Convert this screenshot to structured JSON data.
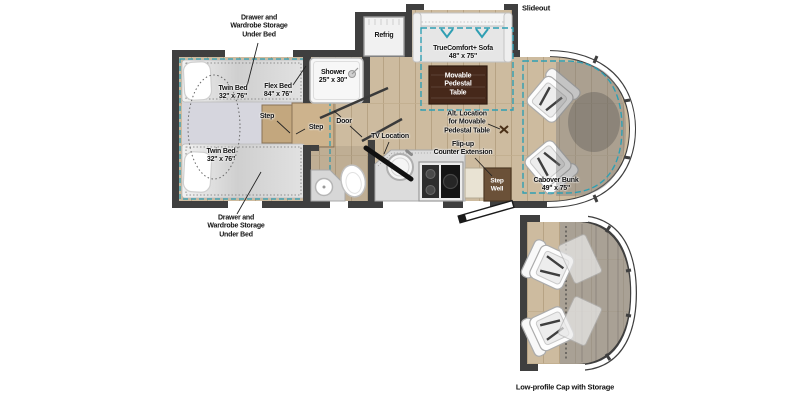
{
  "colors": {
    "wall": "#3f3f3f",
    "floor_wood": "#cdbb9f",
    "accent_teal": "#2f9fb3",
    "table_brown": "#46281a",
    "step_well_brown": "#6b5138",
    "fixture_white": "#f7f7f7",
    "window_white": "#ffffff"
  },
  "labels": {
    "drawer_top": "Drawer and\nWardrobe Storage\nUnder Bed",
    "twin_bed_top": "Twin Bed\n32\" x 76\"",
    "flex_bed": "Flex Bed\n84\" x 76\"",
    "shower": "Shower\n25\" x 30\"",
    "refrig": "Refrig",
    "slideout": "Slideout",
    "sofa": "TrueComfort+ Sofa\n48\" x 75\"",
    "pedestal_table": "Movable\nPedestal\nTable",
    "alt_table": "Alt. Location\nfor Movable\nPedestal Table",
    "flip_up_counter": "Flip-up\nCounter Extension",
    "tv_location": "TV Location",
    "step_1": "Step",
    "step_2": "Step",
    "door": "Door",
    "twin_bed_bottom": "Twin Bed\n32\" x 76\"",
    "drawer_bottom": "Drawer and\nWardrobe Storage\nUnder Bed",
    "step_well": "Step\nWell",
    "cabover_bunk": "Cabover Bunk\n49\" x 75\"",
    "low_profile_cap": "Low-profile Cap with Storage"
  }
}
